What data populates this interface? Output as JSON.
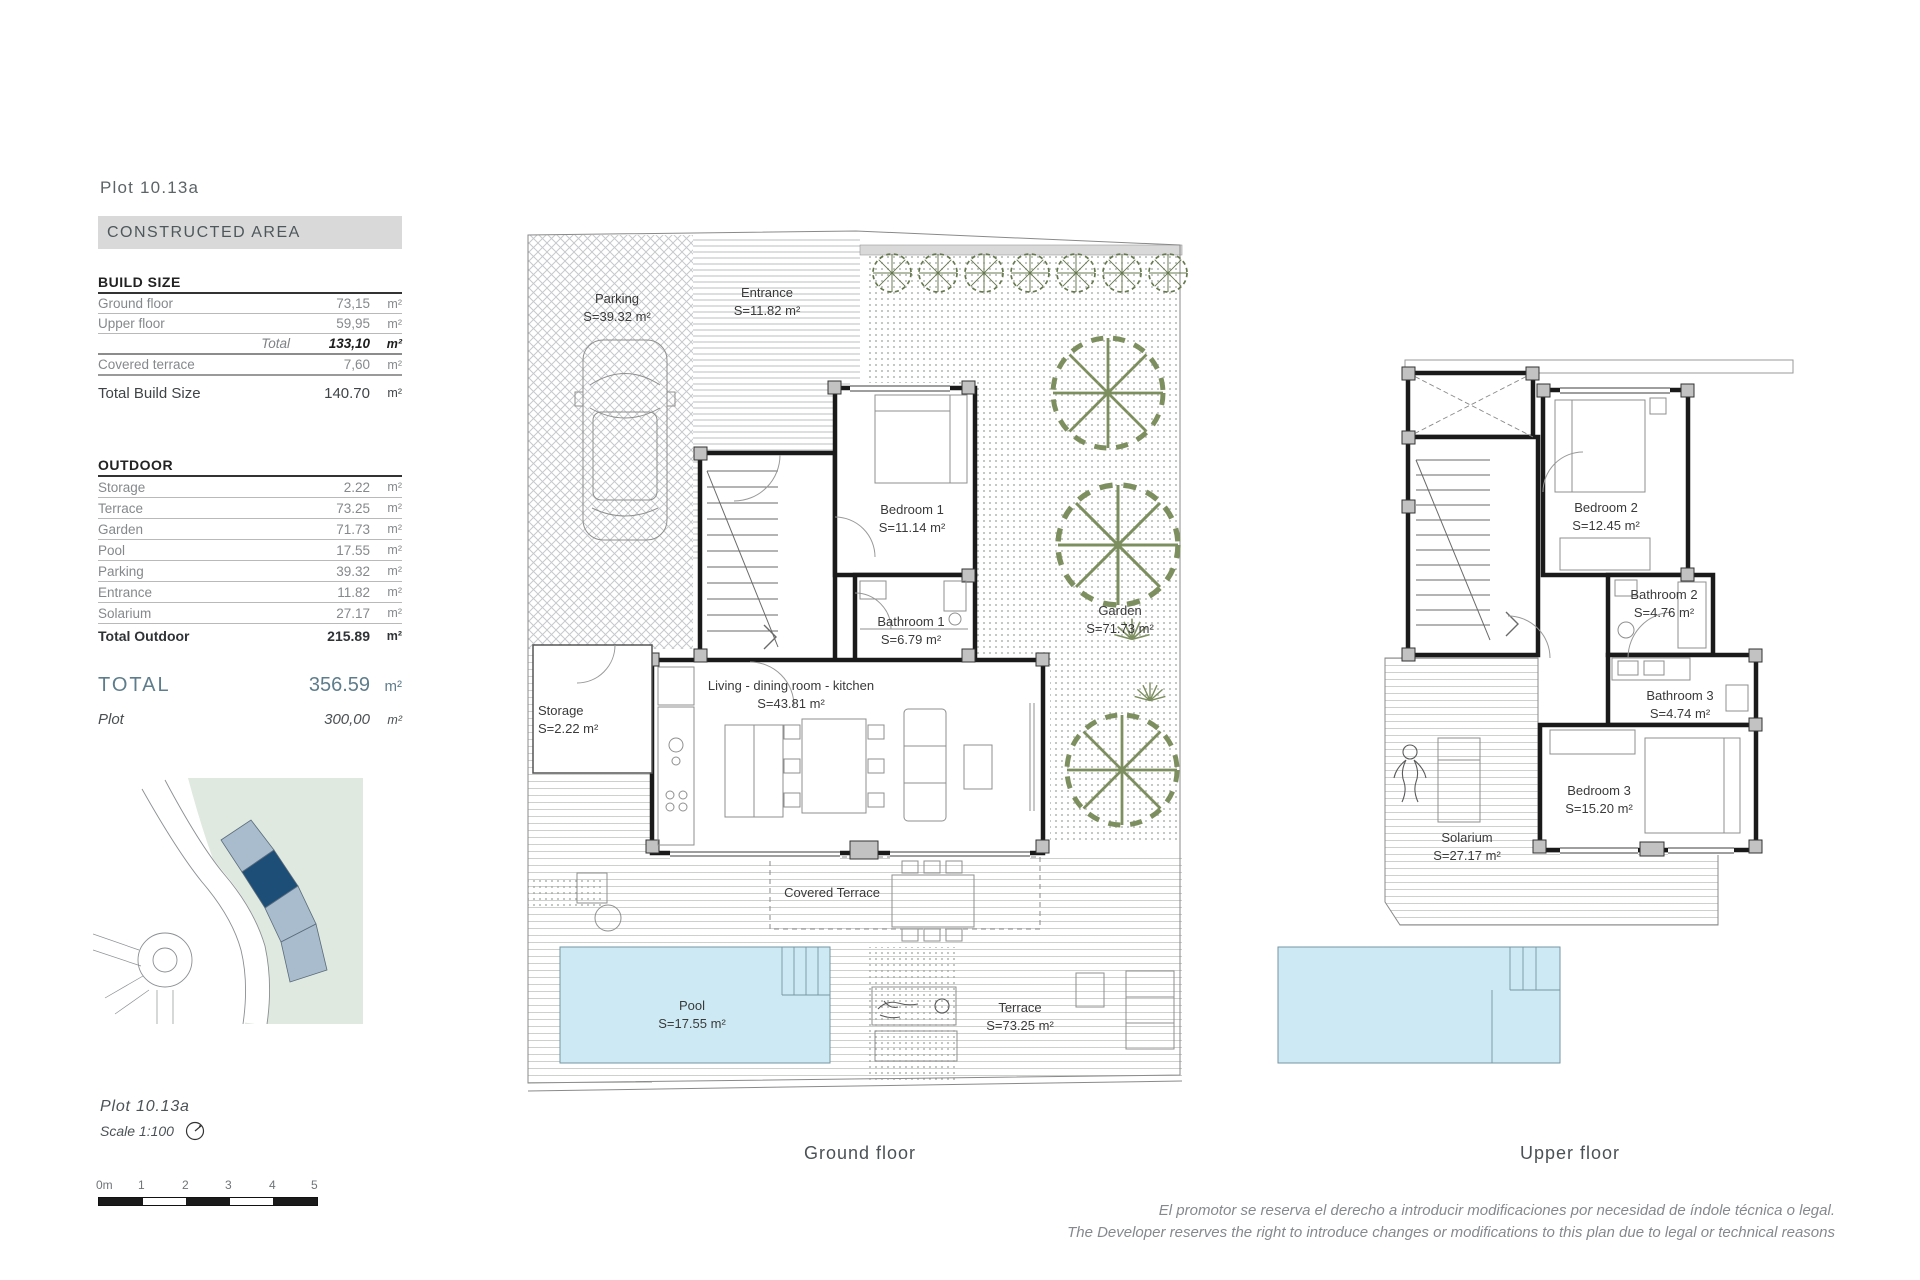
{
  "sidebar": {
    "plot_title": "Plot 10.13a",
    "constructed_area": "CONSTRUCTED AREA",
    "build_size": {
      "header": "BUILD SIZE",
      "rows": [
        {
          "label": "Ground floor",
          "value": "73,15",
          "unit": "m²"
        },
        {
          "label": "Upper floor",
          "value": "59,95",
          "unit": "m²"
        }
      ],
      "total": {
        "label": "Total",
        "value": "133,10",
        "unit": "m²"
      },
      "covered_terrace": {
        "label": "Covered terrace",
        "value": "7,60",
        "unit": "m²"
      },
      "total_build_size": {
        "label": "Total Build Size",
        "value": "140.70",
        "unit": "m²"
      }
    },
    "outdoor": {
      "header": "OUTDOOR",
      "rows": [
        {
          "label": "Storage",
          "value": "2.22",
          "unit": "m²"
        },
        {
          "label": "Terrace",
          "value": "73.25",
          "unit": "m²"
        },
        {
          "label": "Garden",
          "value": "71.73",
          "unit": "m²"
        },
        {
          "label": "Pool",
          "value": "17.55",
          "unit": "m²"
        },
        {
          "label": "Parking",
          "value": "39.32",
          "unit": "m²"
        },
        {
          "label": "Entrance",
          "value": "11.82",
          "unit": "m²"
        },
        {
          "label": "Solarium",
          "value": "27.17",
          "unit": "m²"
        }
      ],
      "total": {
        "label": "Total Outdoor",
        "value": "215.89",
        "unit": "m²"
      }
    },
    "total": {
      "label": "TOTAL",
      "value": "356.59",
      "unit": "m²"
    },
    "plot": {
      "label": "Plot",
      "value": "300,00",
      "unit": "m²"
    },
    "scale_block": {
      "plot_name": "Plot 10.13a",
      "scale": "Scale 1:100"
    },
    "scale_bar": {
      "labels": [
        "0m",
        "1",
        "2",
        "3",
        "4",
        "5"
      ]
    }
  },
  "ground_floor": {
    "caption": "Ground floor",
    "rooms": {
      "parking": {
        "name": "Parking",
        "area": "S=39.32 m²"
      },
      "entrance": {
        "name": "Entrance",
        "area": "S=11.82 m²"
      },
      "bedroom1": {
        "name": "Bedroom 1",
        "area": "S=11.14 m²"
      },
      "bathroom1": {
        "name": "Bathroom 1",
        "area": "S=6.79 m²"
      },
      "living": {
        "name": "Living - dining  room - kitchen",
        "area": "S=43.81 m²"
      },
      "storage": {
        "name": "Storage",
        "area": "S=2.22 m²"
      },
      "garden": {
        "name": "Garden",
        "area": "S=71.73 m²"
      },
      "covered_terrace": {
        "name": "Covered Terrace"
      },
      "pool": {
        "name": "Pool",
        "area": "S=17.55 m²"
      },
      "terrace": {
        "name": "Terrace",
        "area": "S=73.25 m²"
      }
    }
  },
  "upper_floor": {
    "caption": "Upper floor",
    "rooms": {
      "bedroom2": {
        "name": "Bedroom 2",
        "area": "S=12.45 m²"
      },
      "bathroom2": {
        "name": "Bathroom 2",
        "area": "S=4.76 m²"
      },
      "bathroom3": {
        "name": "Bathroom 3",
        "area": "S=4.74 m²"
      },
      "bedroom3": {
        "name": "Bedroom 3",
        "area": "S=15.20 m²"
      },
      "solarium": {
        "name": "Solarium",
        "area": "S=27.17 m²"
      }
    }
  },
  "footer": {
    "line_es": "El promotor se reserva el derecho a introducir modificaciones por necesidad de índole técnica o legal.",
    "line_en": "The Developer reserves the right to introduce changes or modifications to this plan due to legal or technical reasons"
  },
  "colors": {
    "pool": "#cdeaf4",
    "map_green": "#dfe9df",
    "plot_selected": "#1d4e78",
    "plot_adjacent": "#a8bcce",
    "tree_green": "#7d8f5f",
    "accent": "#5e7d8c",
    "header_bar": "#d9d9d9"
  }
}
